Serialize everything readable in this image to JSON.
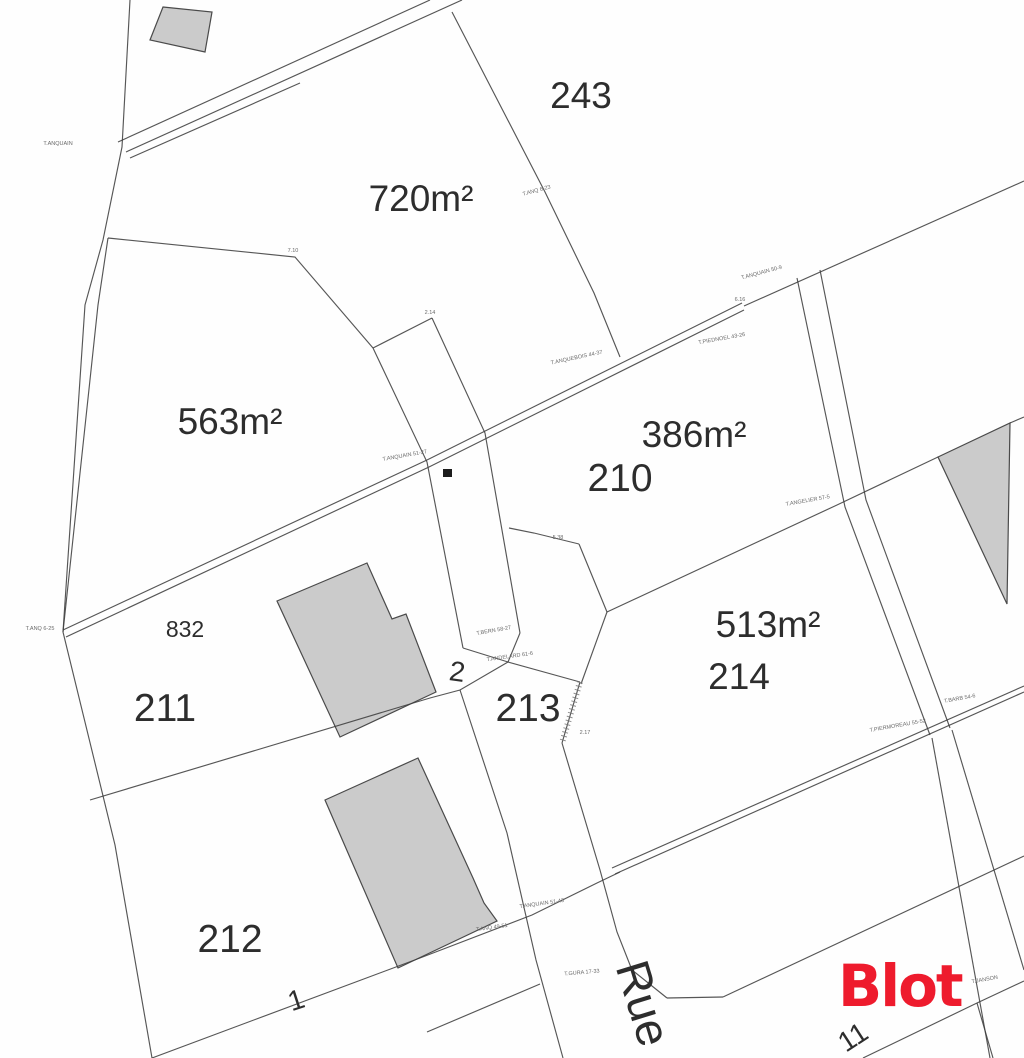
{
  "map": {
    "background": "#fefefe",
    "line_color": "#3f3f3f",
    "building_fill": "#cbcbcb",
    "building_stroke": "#4a4a4a",
    "label_color": "#2d2d2d",
    "survey_color": "#6a6a6a",
    "area_labels": [
      {
        "id": "area-720",
        "text": "720m²",
        "x": 421,
        "y": 211,
        "size": 37
      },
      {
        "id": "area-563",
        "text": "563m²",
        "x": 230,
        "y": 434,
        "size": 37
      },
      {
        "id": "area-386",
        "text": "386m²",
        "x": 694,
        "y": 447,
        "size": 37
      },
      {
        "id": "area-513",
        "text": "513m²",
        "x": 768,
        "y": 637,
        "size": 37
      }
    ],
    "parcel_numbers": [
      {
        "id": "parcel-243",
        "text": "243",
        "x": 581,
        "y": 108,
        "size": 37,
        "rotate": 0
      },
      {
        "id": "parcel-210",
        "text": "210",
        "x": 620,
        "y": 491,
        "size": 39,
        "rotate": 0
      },
      {
        "id": "parcel-214",
        "text": "214",
        "x": 739,
        "y": 689,
        "size": 37,
        "rotate": 0
      },
      {
        "id": "parcel-832",
        "text": "832",
        "x": 185,
        "y": 637,
        "size": 23,
        "rotate": 0
      },
      {
        "id": "parcel-211",
        "text": "211",
        "x": 165,
        "y": 721,
        "size": 39,
        "rotate": 0
      },
      {
        "id": "parcel-213",
        "text": "213",
        "x": 528,
        "y": 721,
        "size": 39,
        "rotate": 0
      },
      {
        "id": "parcel-212",
        "text": "212",
        "x": 230,
        "y": 952,
        "size": 39,
        "rotate": 0
      }
    ],
    "lot_numbers": [
      {
        "id": "lot-2",
        "text": "2",
        "x": 456,
        "y": 681,
        "size": 28,
        "rotate": 8
      },
      {
        "id": "lot-1",
        "text": "1",
        "x": 299,
        "y": 1009,
        "size": 28,
        "rotate": -18
      },
      {
        "id": "lot-11",
        "text": "11",
        "x": 858,
        "y": 1045,
        "size": 28,
        "rotate": -33
      }
    ],
    "street": {
      "id": "street-rue",
      "text": "Rue",
      "x": 628,
      "y": 1008,
      "size": 47,
      "rotate": 73
    },
    "logo": {
      "text": "Blot",
      "x": 838,
      "y": 957,
      "size": 58,
      "color": "#ee1b2d"
    },
    "survey_marks": [
      {
        "text": "T.ANQUAIN",
        "x": 58,
        "y": 145,
        "rotate": 0
      },
      {
        "text": "T.ANQ 6-23",
        "x": 537,
        "y": 192,
        "rotate": -15
      },
      {
        "text": "T.ANQUAIN 50-9",
        "x": 762,
        "y": 274,
        "rotate": -15
      },
      {
        "text": "T.ANQUEBOIS 44-37",
        "x": 577,
        "y": 359,
        "rotate": -12
      },
      {
        "text": "T.PIEDNOEL 43-26",
        "x": 722,
        "y": 340,
        "rotate": -10
      },
      {
        "text": "T.ANQUAIN 51-27",
        "x": 405,
        "y": 457,
        "rotate": -10
      },
      {
        "text": "T.ANGELIER 57-5",
        "x": 808,
        "y": 502,
        "rotate": -10
      },
      {
        "text": "T.ANQ 6-25",
        "x": 40,
        "y": 630,
        "rotate": 0
      },
      {
        "text": "T.BERN 58-27",
        "x": 494,
        "y": 632,
        "rotate": -10
      },
      {
        "text": "T.ANDELARD 61-6",
        "x": 510,
        "y": 658,
        "rotate": -8
      },
      {
        "text": "2.17",
        "x": 585,
        "y": 734,
        "rotate": 0
      },
      {
        "text": "T.PIERMOREAU 55-52",
        "x": 898,
        "y": 727,
        "rotate": -10
      },
      {
        "text": "T.BARB 54-6",
        "x": 960,
        "y": 700,
        "rotate": -10
      },
      {
        "text": "T.ANQUAIN 51-43",
        "x": 542,
        "y": 905,
        "rotate": -8
      },
      {
        "text": "T.ANQ 49-51",
        "x": 492,
        "y": 929,
        "rotate": -8
      },
      {
        "text": "T.GURA 17-33",
        "x": 582,
        "y": 974,
        "rotate": -5
      },
      {
        "text": "T.JANSON",
        "x": 985,
        "y": 981,
        "rotate": -10
      },
      {
        "text": "7.10",
        "x": 293,
        "y": 252,
        "rotate": 0
      },
      {
        "text": "2.14",
        "x": 430,
        "y": 314,
        "rotate": 0
      },
      {
        "text": "5.38",
        "x": 558,
        "y": 539,
        "rotate": 0
      },
      {
        "text": "6.16",
        "x": 740,
        "y": 301,
        "rotate": 0
      }
    ],
    "geometry": {
      "polylines": [
        {
          "name": "boundary-left-outer",
          "pts": [
            [
              130,
              0
            ],
            [
              122,
              147
            ],
            [
              103,
              240
            ],
            [
              85,
              305
            ],
            [
              63,
              632
            ],
            [
              115,
              845
            ],
            [
              152,
              1058
            ]
          ]
        },
        {
          "name": "boundary-left-inner",
          "pts": [
            [
              108,
              238
            ],
            [
              98,
              305
            ],
            [
              63,
              632
            ]
          ]
        },
        {
          "name": "road-top-upper-edge",
          "pts": [
            [
              118,
              142
            ],
            [
              430,
              0
            ]
          ]
        },
        {
          "name": "road-top-lower-edge",
          "pts": [
            [
              126,
              152
            ],
            [
              462,
              0
            ]
          ]
        },
        {
          "name": "road-top-lower-edge-2",
          "pts": [
            [
              130,
              158
            ],
            [
              300,
              83
            ]
          ]
        },
        {
          "name": "divider-243-720",
          "pts": [
            [
              452,
              12
            ],
            [
              545,
              192
            ],
            [
              594,
              293
            ],
            [
              620,
              357
            ]
          ]
        },
        {
          "name": "divider-720-563",
          "pts": [
            [
              108,
              238
            ],
            [
              295,
              257
            ],
            [
              373,
              348
            ]
          ]
        },
        {
          "name": "strip-middle-left",
          "pts": [
            [
              373,
              348
            ],
            [
              427,
              462
            ],
            [
              463,
              648
            ]
          ]
        },
        {
          "name": "strip-middle-right",
          "pts": [
            [
              432,
              318
            ],
            [
              485,
              433
            ],
            [
              520,
              633
            ]
          ]
        },
        {
          "name": "strip-middle-top",
          "pts": [
            [
              373,
              348
            ],
            [
              432,
              318
            ]
          ]
        },
        {
          "name": "diagonal-upper-line",
          "pts": [
            [
              63,
              630
            ],
            [
              427,
              460
            ],
            [
              742,
              303
            ]
          ]
        },
        {
          "name": "diagonal-lower-line",
          "pts": [
            [
              66,
              637
            ],
            [
              429,
              467
            ],
            [
              744,
              310
            ]
          ]
        },
        {
          "name": "diagonal-east-single",
          "pts": [
            [
              744,
              306
            ],
            [
              1024,
              181
            ]
          ]
        },
        {
          "name": "road-right-west-edge",
          "pts": [
            [
              797,
              278
            ],
            [
              845,
              507
            ],
            [
              930,
              735
            ]
          ]
        },
        {
          "name": "road-right-east-edge",
          "pts": [
            [
              820,
              270
            ],
            [
              866,
              500
            ],
            [
              950,
              728
            ]
          ]
        },
        {
          "name": "road-right-west-low",
          "pts": [
            [
              932,
              738
            ],
            [
              990,
              1058
            ]
          ]
        },
        {
          "name": "road-right-east-low",
          "pts": [
            [
              952,
              730
            ],
            [
              1024,
              970
            ]
          ]
        },
        {
          "name": "boundary-210-214",
          "pts": [
            [
              607,
              612
            ],
            [
              837,
              505
            ],
            [
              938,
              457
            ]
          ]
        },
        {
          "name": "boundary-triangle-ext",
          "pts": [
            [
              1010,
              423
            ],
            [
              1024,
              417
            ]
          ]
        },
        {
          "name": "boundary-south-214-upper",
          "pts": [
            [
              612,
              868
            ],
            [
              1024,
              686
            ]
          ]
        },
        {
          "name": "boundary-south-214-lower",
          "pts": [
            [
              615,
              874
            ],
            [
              1024,
              692
            ]
          ]
        },
        {
          "name": "junction-213-a",
          "pts": [
            [
              463,
              648
            ],
            [
              508,
              662
            ]
          ]
        },
        {
          "name": "junction-213-b",
          "pts": [
            [
              520,
              633
            ],
            [
              508,
              662
            ]
          ]
        },
        {
          "name": "boundary-213-north",
          "pts": [
            [
              508,
              662
            ],
            [
              580,
              682
            ]
          ]
        },
        {
          "name": "divider-214-213",
          "pts": [
            [
              607,
              612
            ],
            [
              581,
              684
            ]
          ]
        },
        {
          "name": "notch-210-a",
          "pts": [
            [
              509,
              528
            ],
            [
              534,
              533
            ],
            [
              579,
              544
            ]
          ]
        },
        {
          "name": "notch-210-b",
          "pts": [
            [
              579,
              544
            ],
            [
              607,
              612
            ]
          ]
        },
        {
          "name": "divider-211-212",
          "pts": [
            [
              508,
              662
            ],
            [
              460,
              690
            ],
            [
              430,
              698
            ],
            [
              90,
              800
            ]
          ]
        },
        {
          "name": "street-west-edge",
          "pts": [
            [
              460,
              690
            ],
            [
              507,
              833
            ],
            [
              536,
              960
            ],
            [
              563,
              1058
            ]
          ]
        },
        {
          "name": "street-east-edge",
          "pts": [
            [
              562,
              743
            ],
            [
              600,
              870
            ],
            [
              617,
              932
            ],
            [
              632,
              970
            ],
            [
              667,
              998
            ]
          ]
        },
        {
          "name": "street-bottom-flat",
          "pts": [
            [
              667,
              998
            ],
            [
              723,
              997
            ]
          ]
        },
        {
          "name": "boundary-lot11-north",
          "pts": [
            [
              723,
              997
            ],
            [
              1024,
              856
            ]
          ]
        },
        {
          "name": "boundary-lot11-south",
          "pts": [
            [
              863,
              1058
            ],
            [
              977,
              1003
            ],
            [
              1024,
              981
            ]
          ]
        },
        {
          "name": "boundary-lot11-branch",
          "pts": [
            [
              977,
              1003
            ],
            [
              993,
              1058
            ]
          ]
        },
        {
          "name": "boundary-south-212",
          "pts": [
            [
              152,
              1058
            ],
            [
              420,
              958
            ],
            [
              532,
              915
            ],
            [
              597,
              883
            ],
            [
              620,
              872
            ]
          ]
        },
        {
          "name": "boundary-lot1-south",
          "pts": [
            [
              427,
              1032
            ],
            [
              540,
              984
            ]
          ]
        }
      ],
      "hatch_segment": {
        "name": "hatched-boundary",
        "pts": [
          [
            580,
            682
          ],
          [
            562,
            743
          ]
        ]
      },
      "polygons": [
        {
          "name": "building-top-left",
          "pts": [
            [
              163,
              7
            ],
            [
              212,
              12
            ],
            [
              205,
              52
            ],
            [
              150,
              40
            ]
          ],
          "kind": "building"
        },
        {
          "name": "building-parcel-211",
          "pts": [
            [
              277,
              601
            ],
            [
              367,
              563
            ],
            [
              392,
              619
            ],
            [
              406,
              614
            ],
            [
              436,
              692
            ],
            [
              340,
              737
            ]
          ],
          "kind": "building"
        },
        {
          "name": "building-parcel-212",
          "pts": [
            [
              325,
              800
            ],
            [
              418,
              758
            ],
            [
              473,
              878
            ],
            [
              484,
              903
            ],
            [
              497,
              921
            ],
            [
              398,
              968
            ]
          ],
          "kind": "building"
        },
        {
          "name": "building-east-triangle",
          "pts": [
            [
              938,
              457
            ],
            [
              1010,
              423
            ],
            [
              1007,
              604
            ]
          ],
          "kind": "building"
        },
        {
          "name": "boundary-marker-square",
          "pts": [
            [
              443,
              469
            ],
            [
              452,
              469
            ],
            [
              452,
              477
            ],
            [
              443,
              477
            ]
          ],
          "kind": "marker"
        }
      ]
    }
  }
}
